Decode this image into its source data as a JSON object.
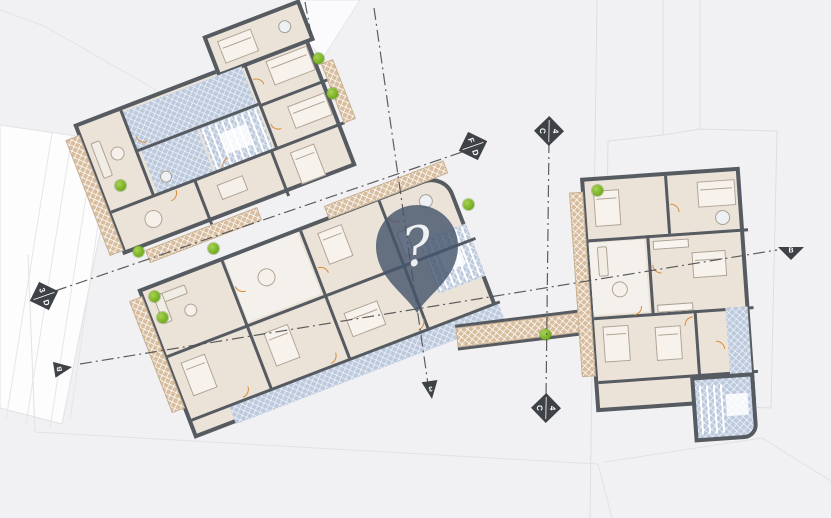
{
  "plan": {
    "type": "architectural-floor-plan",
    "colors": {
      "background": "#f1f1f3",
      "wall": "#565b62",
      "room_fill": "#ebe3d7",
      "corridor_blue": "#bdcade",
      "balcony_tan": "#d8bd9f",
      "door_orange": "#d98a35",
      "tree_green": "#76b32a",
      "axis_line": "#4d4d4f",
      "marker_fill": "#3e4247",
      "marker_text": "#ffffff"
    }
  },
  "pin": {
    "icon": "question-mark",
    "glyph": "?",
    "fill": "#46556c"
  },
  "axis_markers": [
    {
      "id": "left-diamond",
      "shape": "diamond",
      "labels": [
        "3",
        "D"
      ]
    },
    {
      "id": "upper-right-diamond",
      "shape": "diamond",
      "labels": [
        "F",
        "D"
      ]
    },
    {
      "id": "top-diamond",
      "shape": "diamond",
      "labels": [
        "C",
        "4"
      ]
    },
    {
      "id": "bottom-diamond",
      "shape": "diamond",
      "labels": [
        "C",
        "4"
      ]
    },
    {
      "id": "lower-left-triangle",
      "shape": "triangle",
      "labels": [
        "B"
      ]
    },
    {
      "id": "right-triangle",
      "shape": "triangle",
      "labels": [
        "B"
      ]
    },
    {
      "id": "bottom-triangle",
      "shape": "triangle",
      "labels": [
        "3"
      ]
    }
  ]
}
